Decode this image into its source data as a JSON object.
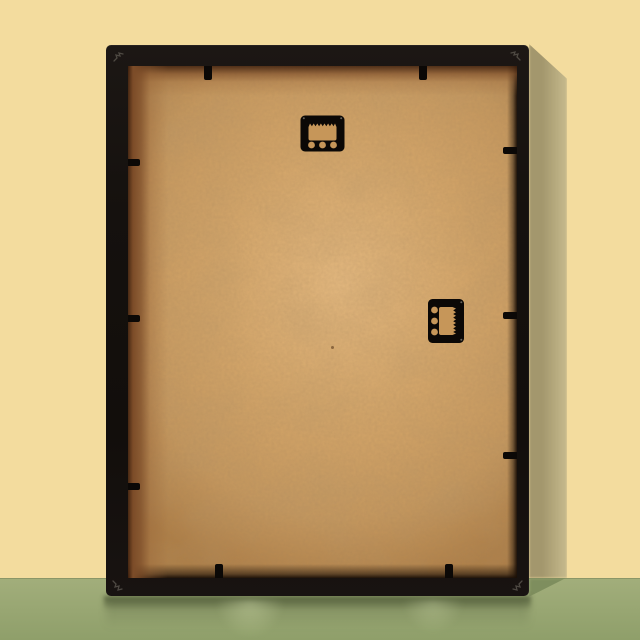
{
  "scene": {
    "type": "photograph",
    "subject": "Back of a black picture frame with a tan MDF backing board, leaning against a pale yellow wall on a green surface",
    "objects": {
      "frame": "black picture frame, rear view",
      "backing_board": "kraft / MDF backing board",
      "hanger_top": "sawtooth hanger, horizontal, top centre",
      "hanger_right": "sawtooth hanger, rotated 90 degrees, middle right",
      "retainer_clips": {
        "top": 2,
        "bottom": 2,
        "left": 3,
        "right": 3
      },
      "corner_marks": 4,
      "cast_shadow": "soft shadow on wall to the right of frame",
      "reflection": "faint reflection of frame on glossy green surface"
    }
  },
  "palette": {
    "wall": "#f3dc9e",
    "wallShadowDark": "#a3976d",
    "wallShadowLight": "#c2b689",
    "floor": "#a2ae7b",
    "floorBottom": "#8f9f6a",
    "floorShadow": "#7b8b5b",
    "frameBlack": "#15110e",
    "boardTan": "#d2a468",
    "boardLight": "#e2b77e",
    "boardDark": "#ad7e47",
    "rabbetBrown": "#7c4c28",
    "hardwareBlack": "#0b0806",
    "boardThroughHole": "#c69659",
    "cornerMark": "#57524b"
  }
}
